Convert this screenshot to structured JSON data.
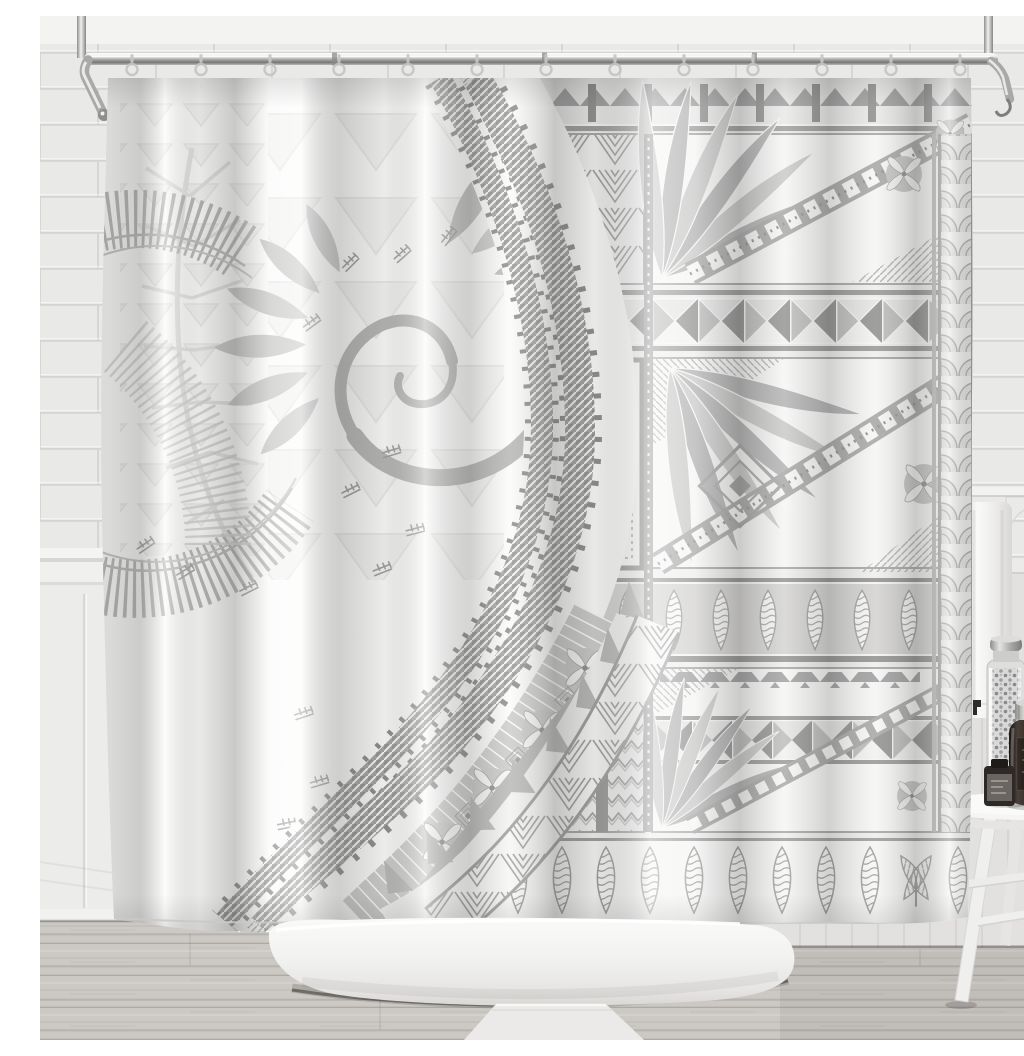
{
  "scene": {
    "description": "Product photo of a white and grey Polynesian tapa-pattern shower curtain hanging from a chrome rod in a bright bathroom with subway tile walls, a white freestanding bathtub, wood floor, and a white stool with jars",
    "objects": [
      {
        "id": "shower-curtain",
        "label": "Polynesian grey tapa pattern shower curtain"
      },
      {
        "id": "shower-rod",
        "label": "Chrome L-shaped shower curtain rod with ceiling supports"
      },
      {
        "id": "curtain-hooks",
        "label": "Clear shower curtain hooks"
      },
      {
        "id": "bathtub",
        "label": "White freestanding bathtub"
      },
      {
        "id": "tile-wall",
        "label": "White subway tile wall"
      },
      {
        "id": "wainscot",
        "label": "White wainscot panelling with chair rail"
      },
      {
        "id": "beadboard-wall",
        "label": "Light grey panelled lower wall"
      },
      {
        "id": "wood-floor",
        "label": "Light grey wood plank floor"
      },
      {
        "id": "bath-mat",
        "label": "White bath mat"
      },
      {
        "id": "wall-shelf",
        "label": "Small white wall shelf with corbel bracket"
      },
      {
        "id": "towel",
        "label": "White towel hanging beside curtain"
      },
      {
        "id": "wall-hook",
        "label": "Small dark wall hook"
      },
      {
        "id": "stool",
        "label": "White wooden stool"
      },
      {
        "id": "pebble-jar",
        "label": "Tall glass jar filled with pebbles"
      },
      {
        "id": "amber-jar",
        "label": "Dark amber jar with silver lid"
      },
      {
        "id": "small-bottle",
        "label": "Small dark bottle with grey label"
      }
    ],
    "curtain_motifs": [
      "koru-spiral",
      "fern-frond",
      "radiating-line-arc",
      "serrated-gear-bands",
      "cross-hatch-arc",
      "frangipani-flower-band",
      "shark-teeth-band",
      "spiderweb-triangle-band",
      "tapa-patchwork",
      "pinwheel-square-rows",
      "diagonal-leaf-fans",
      "shield-teardrop-rows",
      "zigzag-columns",
      "scallop-shell-column",
      "tapa-glyphs"
    ]
  },
  "palette": {
    "ceiling": "#f3f3f2",
    "tile": "#e9e9e8",
    "grout": "#d5d4d2",
    "wainscot": "#ececeb",
    "beadboard": "#e2e1df",
    "floor": "#ccc9c4",
    "mat": "#ebeae8",
    "chrome": "#9a9a9a",
    "curtain": "#fbfbfa",
    "pat_dark": "#8e8e8e",
    "pat_mid": "#acacac",
    "pat_light": "#cccccc",
    "pat_faint": "#e3e3e3",
    "tub": "#f6f6f5",
    "towel": "#f2f2f1",
    "amber": "#362f2a",
    "lid": "#c2c2c2",
    "shadow": "#3e3e3e"
  },
  "rod": {
    "hook_count": 13,
    "hook_start_x": 92,
    "hook_spacing": 69
  }
}
